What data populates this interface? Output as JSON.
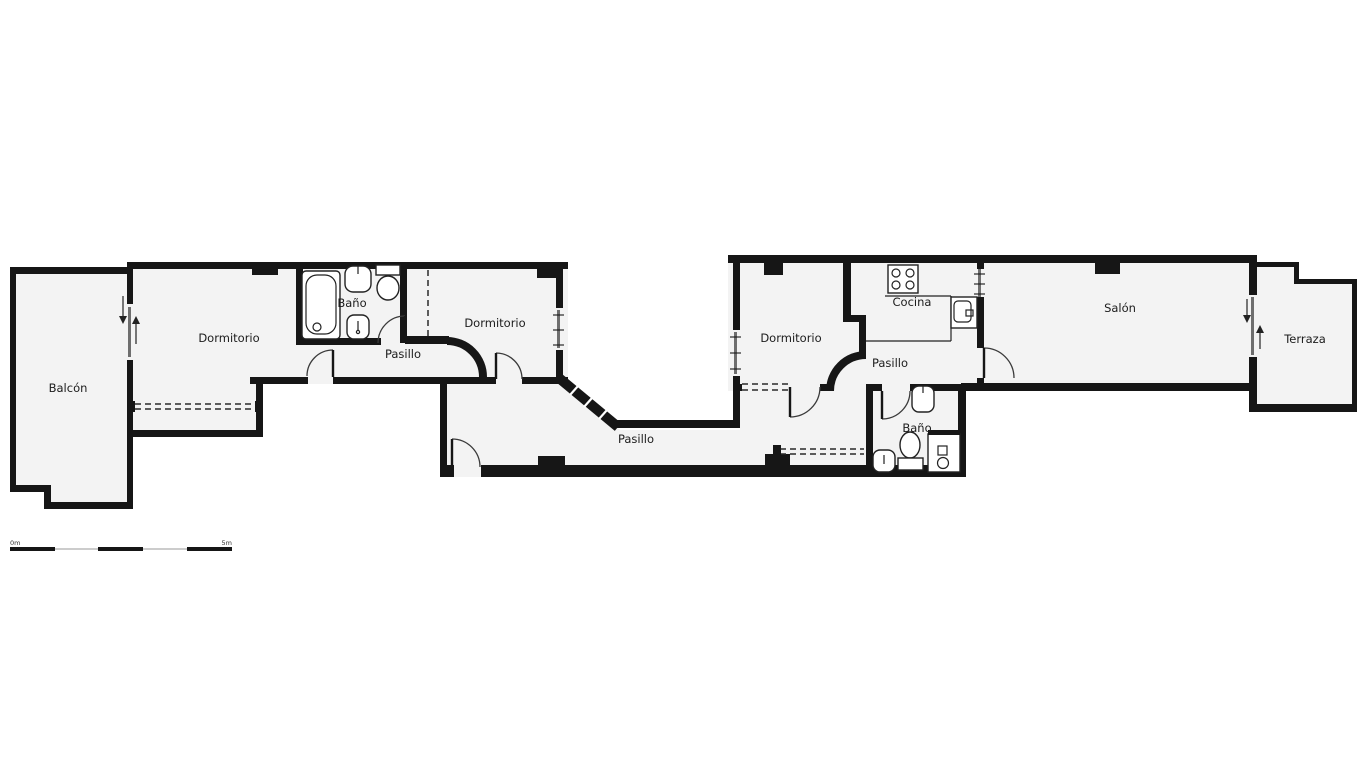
{
  "title": "Floor plan",
  "colors": {
    "wall": "#161616",
    "floor": "#f3f3f3",
    "background": "#ffffff",
    "door_arc": "#3a3a3a"
  },
  "rooms": [
    {
      "id": "balcon",
      "label": "Balcón"
    },
    {
      "id": "dormitorio_1",
      "label": "Dormitorio"
    },
    {
      "id": "bano_1",
      "label": "Baño"
    },
    {
      "id": "pasillo_left",
      "label": "Pasillo"
    },
    {
      "id": "dormitorio_2",
      "label": "Dormitorio"
    },
    {
      "id": "pasillo_central",
      "label": "Pasillo"
    },
    {
      "id": "dormitorio_3",
      "label": "Dormitorio"
    },
    {
      "id": "cocina",
      "label": "Cocina"
    },
    {
      "id": "pasillo_right",
      "label": "Pasillo"
    },
    {
      "id": "bano_2",
      "label": "Baño"
    },
    {
      "id": "salon",
      "label": "Salón"
    },
    {
      "id": "terraza",
      "label": "Terraza"
    }
  ],
  "scale_bar": {
    "start": "0m",
    "end": "5m"
  }
}
